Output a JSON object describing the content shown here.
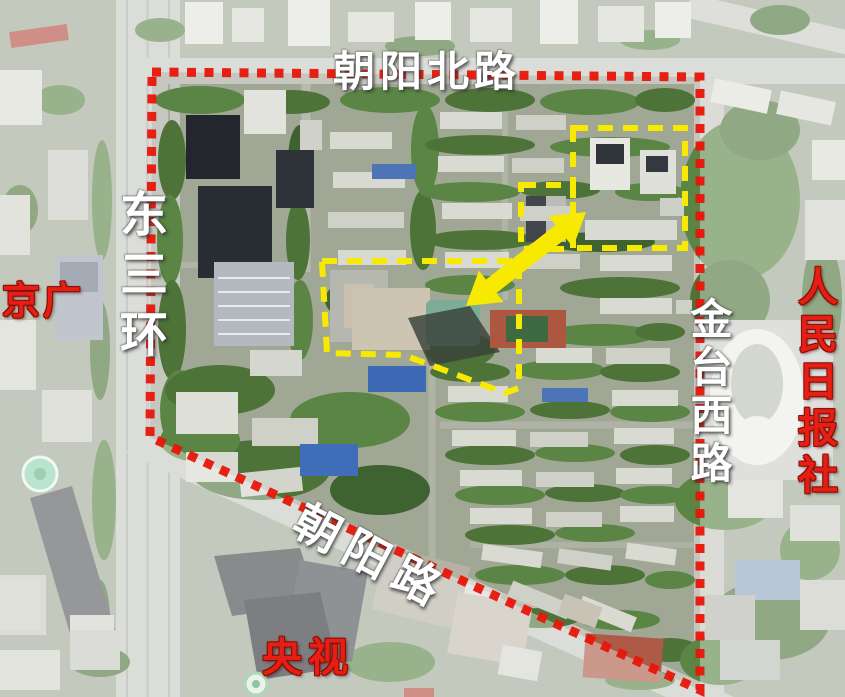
{
  "figure": {
    "kind": "annotated-satellite-map",
    "road_labels": {
      "top": "朝阳北路",
      "left": "东三环",
      "right": "金台西路",
      "bottom": "朝阳路"
    },
    "landmark_labels": {
      "west": "京广",
      "east": "人民日报社",
      "south": "央视"
    },
    "annotation_colors": {
      "site_boundary_dotted": "#e8150a",
      "highlight_dashed": "#f7ea00",
      "arrow_fill": "#f7ea00",
      "road_label_text": "#ffffff",
      "landmark_label_text": "#e61e14"
    }
  }
}
